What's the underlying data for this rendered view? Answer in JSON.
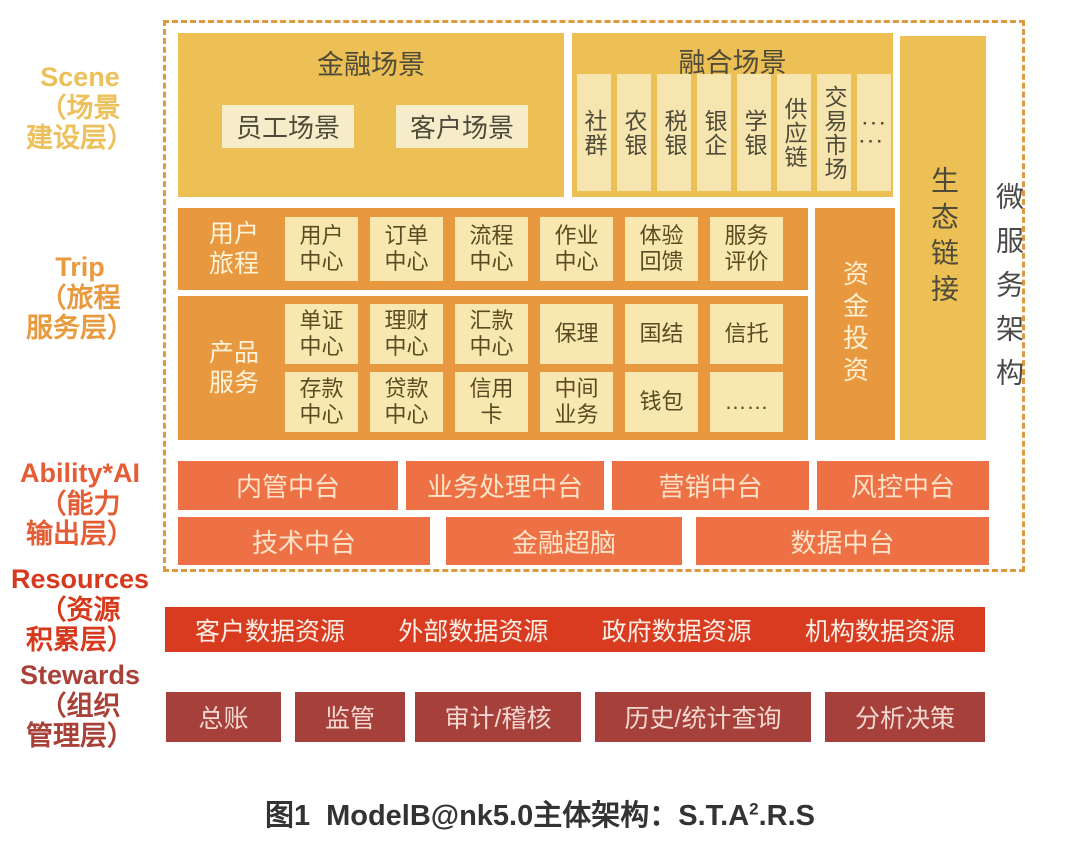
{
  "colors": {
    "gold": "#ecc054",
    "cream": "#f7ecca",
    "orange": "#e8993f",
    "ability_orange": "#ee7145",
    "resources_red": "#d93b20",
    "stewards_maroon": "#a6403a",
    "dashed_border": "#de9b3e"
  },
  "left_labels": [
    {
      "en": "Scene",
      "zh": "（场景\n建设层）"
    },
    {
      "en": "Trip",
      "zh": "（旅程\n服务层）"
    },
    {
      "en": "Ability*AI",
      "zh": "（能力\n输出层）"
    },
    {
      "en": "Resources",
      "zh": "（资源\n积累层）"
    },
    {
      "en": "Stewards",
      "zh": "（组织\n管理层）"
    }
  ],
  "scene_layer": {
    "financial": {
      "title": "金融场景",
      "items": [
        "员工场景",
        "客户场景"
      ]
    },
    "fusion": {
      "title": "融合场景",
      "items": [
        "社群",
        "农银",
        "税银",
        "银企",
        "学银",
        "供应链",
        "交易市场"
      ],
      "ellipsis": "···\n···"
    },
    "eco_link": "生态链接",
    "microservice": "微服务架构"
  },
  "trip_layer": {
    "journey": {
      "label": "用户\n旅程",
      "cells": [
        "用户\n中心",
        "订单\n中心",
        "流程\n中心",
        "作业\n中心",
        "体验\n回馈",
        "服务\n评价"
      ]
    },
    "funding": "资金投资",
    "product": {
      "label": "产品\n服务",
      "row1": [
        "单证\n中心",
        "理财\n中心",
        "汇款\n中心",
        "保理",
        "国结",
        "信托"
      ],
      "row2": [
        "存款\n中心",
        "贷款\n中心",
        "信用\n卡",
        "中间\n业务",
        "钱包",
        "……"
      ]
    }
  },
  "ability_layer": {
    "row1": [
      "内管中台",
      "业务处理中台",
      "营销中台",
      "风控中台"
    ],
    "row2": [
      "技术中台",
      "金融超脑",
      "数据中台"
    ]
  },
  "resources_layer": {
    "items": [
      "客户数据资源",
      "外部数据资源",
      "政府数据资源",
      "机构数据资源"
    ]
  },
  "stewards_layer": {
    "items": [
      "总账",
      "监管",
      "审计/稽核",
      "历史/统计查询",
      "分析决策"
    ]
  },
  "caption": {
    "prefix": "图1",
    "main": "ModelB@nk5.0主体架构：S.T.A",
    "sup": "2",
    "suffix": ".R.S"
  }
}
